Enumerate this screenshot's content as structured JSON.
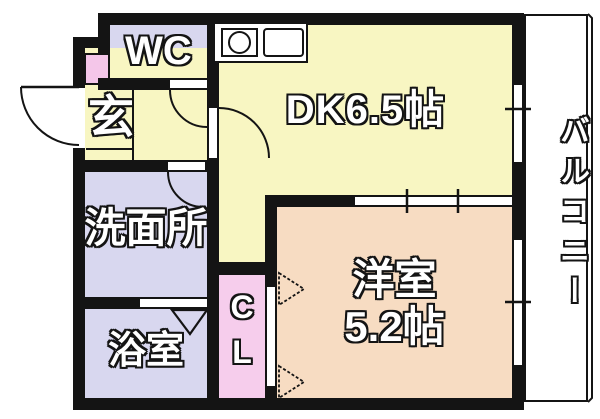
{
  "plan_type": "apartment-floor-plan",
  "rooms": {
    "wc": "WC",
    "dk": "DK6.5帖",
    "genkan": "玄",
    "washroom": "洗面所",
    "bathroom": "浴室",
    "closet": {
      "line1": "C",
      "line2": "L"
    },
    "western": {
      "line1": "洋室",
      "line2": "5.2帖"
    },
    "balcony": "バルコニー"
  },
  "colors": {
    "wall": "#141414",
    "dk_hall_yellow": "#f8f6c2",
    "wc_wash_bath_lavender": "#d8d7ef",
    "closet_pink": "#f6cdec",
    "shoe_cabinet_pink": "#f4c6e9",
    "western_room_peach": "#f7dcc2",
    "balcony_white": "#ffffff",
    "label_fill": "#ffffff",
    "label_outline": "#141414"
  },
  "icons": {
    "kitchen_counter": "kitchen-counter-icon",
    "sink": "sink-circle-icon",
    "entrance_door": "door-swing-arc",
    "wc_door": "door-swing-arc",
    "washroom_door": "door-swing-arc",
    "dk_door": "door-swing-arc",
    "bathroom_door": "folding-door-triangle",
    "closet_doors": "folding-door-arrows",
    "windows": "window-with-tick",
    "dk_western_partition": "sliding-door-with-ticks"
  }
}
